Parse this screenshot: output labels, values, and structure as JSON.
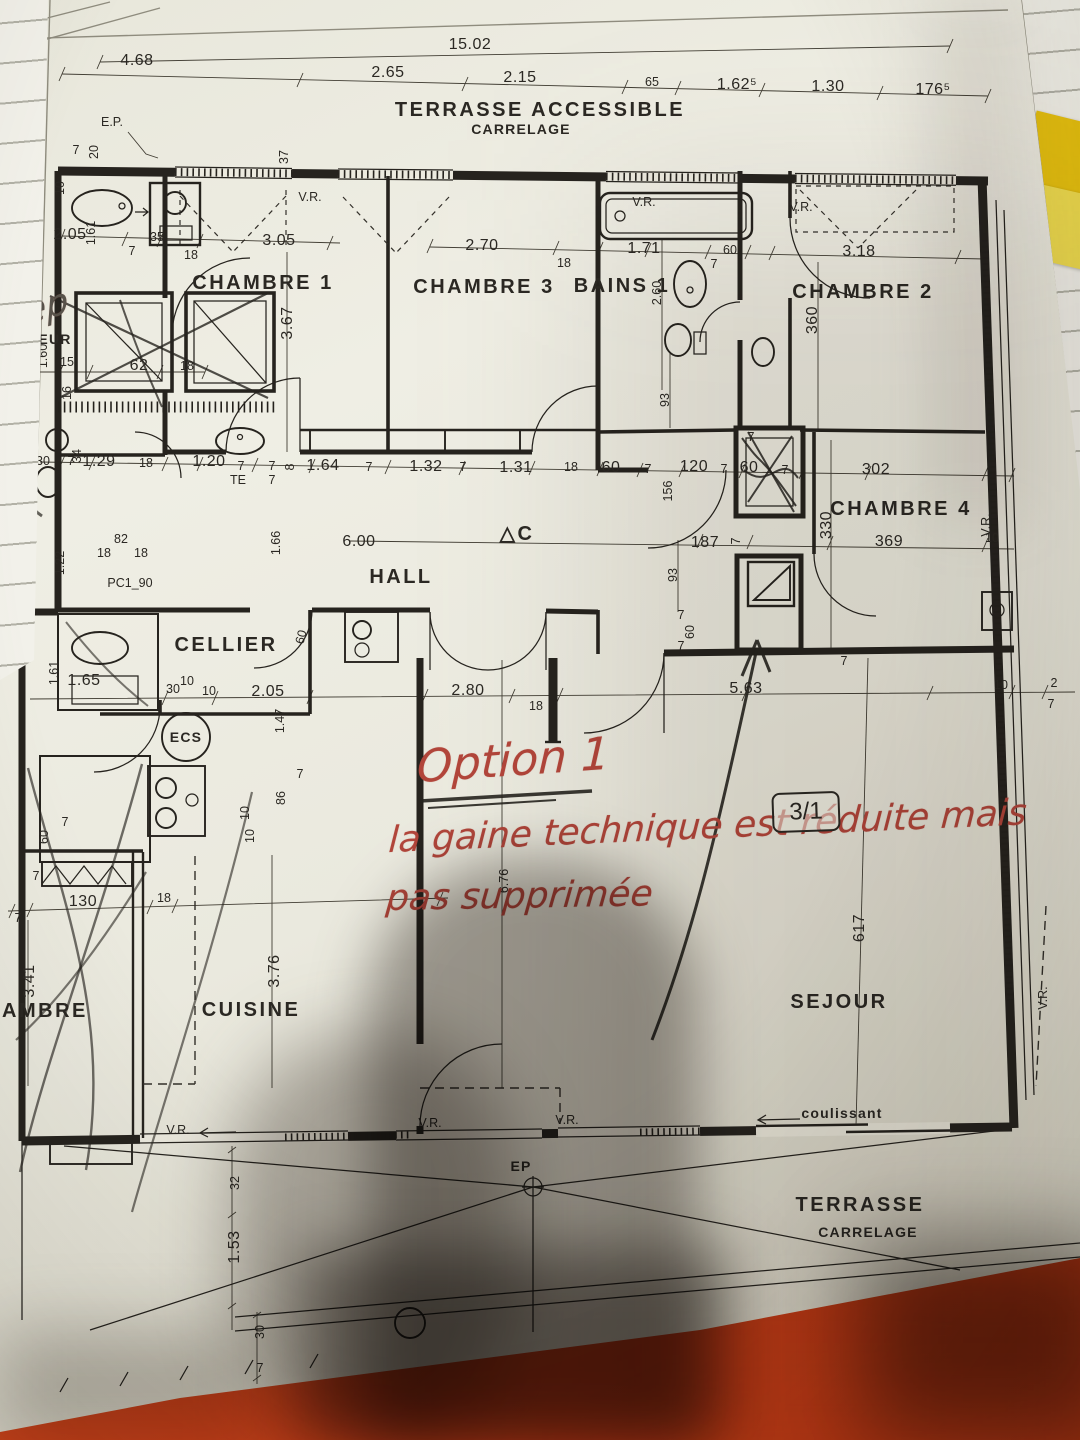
{
  "scene": {
    "table_color": "#c93c15",
    "paper_color": "#eae9de",
    "sticky_colors": [
      "#e8c20e",
      "#f0dd4e"
    ],
    "ink_color": "#26231e",
    "red_ink_color": "#b0453c"
  },
  "annotations": {
    "pencil_note": "Dep",
    "red_title": "Option 1",
    "red_line1": "la gaine technique est réduite mais",
    "red_line2": "pas supprimée",
    "plan_ref": "3/1"
  },
  "plan": {
    "texts": [
      {
        "t": "15.02",
        "x": 470,
        "y": 49,
        "k": "d"
      },
      {
        "t": "4.68",
        "x": 137,
        "y": 65,
        "k": "d"
      },
      {
        "t": "2.65",
        "x": 388,
        "y": 77,
        "k": "d"
      },
      {
        "t": "2.15",
        "x": 520,
        "y": 82,
        "k": "d"
      },
      {
        "t": "65",
        "x": 652,
        "y": 86,
        "k": "t"
      },
      {
        "t": "1.62⁵",
        "x": 737,
        "y": 89,
        "k": "d"
      },
      {
        "t": "1.30",
        "x": 828,
        "y": 91,
        "k": "d"
      },
      {
        "t": "176⁵",
        "x": 933,
        "y": 94,
        "k": "d"
      },
      {
        "t": "TERRASSE ACCESSIBLE",
        "x": 540,
        "y": 116,
        "k": "r"
      },
      {
        "t": "CARRELAGE",
        "x": 521,
        "y": 134,
        "k": "l"
      },
      {
        "t": "E.P.",
        "x": 112,
        "y": 126,
        "k": "t"
      },
      {
        "t": "7",
        "x": 76,
        "y": 154,
        "k": "t"
      },
      {
        "t": "20",
        "x": 98,
        "y": 152,
        "k": "t",
        "r": -90
      },
      {
        "t": "37",
        "x": 288,
        "y": 157,
        "k": "t",
        "r": -90
      },
      {
        "t": "10",
        "x": 64,
        "y": 188,
        "k": "t",
        "r": -90
      },
      {
        "t": "V.R.",
        "x": 310,
        "y": 201,
        "k": "t"
      },
      {
        "t": "V.R.",
        "x": 644,
        "y": 206,
        "k": "t"
      },
      {
        "t": "V.R.",
        "x": 801,
        "y": 211,
        "k": "t"
      },
      {
        "t": "2.05",
        "x": 70,
        "y": 239,
        "k": "d"
      },
      {
        "t": "1.61",
        "x": 95,
        "y": 233,
        "k": "t",
        "r": -90
      },
      {
        "t": "35",
        "x": 157,
        "y": 241,
        "k": "t"
      },
      {
        "t": "7",
        "x": 132,
        "y": 255,
        "k": "t"
      },
      {
        "t": "18",
        "x": 191,
        "y": 259,
        "k": "t"
      },
      {
        "t": "3.05",
        "x": 279,
        "y": 245,
        "k": "d"
      },
      {
        "t": "2.70",
        "x": 482,
        "y": 250,
        "k": "d"
      },
      {
        "t": "18",
        "x": 564,
        "y": 267,
        "k": "t"
      },
      {
        "t": "1.71",
        "x": 644,
        "y": 253,
        "k": "d"
      },
      {
        "t": "7",
        "x": 714,
        "y": 268,
        "k": "t"
      },
      {
        "t": "60",
        "x": 730,
        "y": 254,
        "k": "t"
      },
      {
        "t": "3.18",
        "x": 859,
        "y": 256,
        "k": "d"
      },
      {
        "t": "CHAMBRE 1",
        "x": 263,
        "y": 289,
        "k": "r"
      },
      {
        "t": "CHAMBRE 3",
        "x": 484,
        "y": 293,
        "k": "r"
      },
      {
        "t": "BAINS 1",
        "x": 622,
        "y": 292,
        "k": "r"
      },
      {
        "t": "CHAMBRE 2",
        "x": 863,
        "y": 298,
        "k": "r"
      },
      {
        "t": "3.67",
        "x": 292,
        "y": 323,
        "k": "d",
        "r": -90
      },
      {
        "t": "2.60",
        "x": 661,
        "y": 293,
        "k": "t",
        "r": -90
      },
      {
        "t": "360",
        "x": 817,
        "y": 320,
        "k": "d",
        "r": -90
      },
      {
        "t": "EUR",
        "x": 55,
        "y": 344,
        "k": "l"
      },
      {
        "t": "1.60",
        "x": 47,
        "y": 356,
        "k": "t",
        "r": -90
      },
      {
        "t": "50",
        "x": 18,
        "y": 365,
        "k": "t"
      },
      {
        "t": "15",
        "x": 67,
        "y": 366,
        "k": "t"
      },
      {
        "t": "62",
        "x": 139,
        "y": 370,
        "k": "d"
      },
      {
        "t": "18",
        "x": 187,
        "y": 370,
        "k": "t"
      },
      {
        "t": "16",
        "x": 71,
        "y": 393,
        "k": "t",
        "r": -90
      },
      {
        "t": "93",
        "x": 669,
        "y": 400,
        "k": "t",
        "r": -90
      },
      {
        "t": "30",
        "x": 43,
        "y": 465,
        "k": "t"
      },
      {
        "t": "7",
        "x": 71,
        "y": 465,
        "k": "t"
      },
      {
        "t": "1.29",
        "x": 99,
        "y": 466,
        "k": "d"
      },
      {
        "t": "18",
        "x": 146,
        "y": 467,
        "k": "t"
      },
      {
        "t": "34",
        "x": 81,
        "y": 456,
        "k": "t",
        "r": -90
      },
      {
        "t": "1.20",
        "x": 209,
        "y": 466,
        "k": "d"
      },
      {
        "t": "7",
        "x": 241,
        "y": 470,
        "k": "t"
      },
      {
        "t": "TE",
        "x": 238,
        "y": 484,
        "k": "t"
      },
      {
        "t": "7",
        "x": 272,
        "y": 470,
        "k": "t"
      },
      {
        "t": "7",
        "x": 272,
        "y": 484,
        "k": "t"
      },
      {
        "t": "8",
        "x": 294,
        "y": 467,
        "k": "t",
        "r": -90
      },
      {
        "t": "1.64",
        "x": 323,
        "y": 470,
        "k": "d"
      },
      {
        "t": "7",
        "x": 369,
        "y": 471,
        "k": "t"
      },
      {
        "t": "1.32",
        "x": 426,
        "y": 471,
        "k": "d"
      },
      {
        "t": "7",
        "x": 463,
        "y": 471,
        "k": "t"
      },
      {
        "t": "1.31",
        "x": 516,
        "y": 472,
        "k": "d"
      },
      {
        "t": "18",
        "x": 571,
        "y": 471,
        "k": "t"
      },
      {
        "t": "60",
        "x": 611,
        "y": 472,
        "k": "d"
      },
      {
        "t": "7",
        "x": 648,
        "y": 473,
        "k": "t"
      },
      {
        "t": "120",
        "x": 694,
        "y": 471,
        "k": "d"
      },
      {
        "t": "7",
        "x": 724,
        "y": 473,
        "k": "t"
      },
      {
        "t": "60",
        "x": 749,
        "y": 472,
        "k": "d"
      },
      {
        "t": "7",
        "x": 785,
        "y": 474,
        "k": "t"
      },
      {
        "t": "302",
        "x": 876,
        "y": 474,
        "k": "d"
      },
      {
        "t": "156",
        "x": 672,
        "y": 491,
        "k": "t",
        "r": -90
      },
      {
        "t": "7",
        "x": 751,
        "y": 441,
        "k": "t"
      },
      {
        "t": "CHAMBRE 4",
        "x": 901,
        "y": 515,
        "k": "r"
      },
      {
        "t": "330",
        "x": 831,
        "y": 525,
        "k": "d",
        "r": -90
      },
      {
        "t": "V.R.",
        "x": 990,
        "y": 525,
        "k": "t",
        "r": -90
      },
      {
        "t": "10",
        "x": 992,
        "y": 542,
        "k": "t"
      },
      {
        "t": "369",
        "x": 889,
        "y": 546,
        "k": "d"
      },
      {
        "t": "187",
        "x": 705,
        "y": 547,
        "k": "d"
      },
      {
        "t": "7",
        "x": 740,
        "y": 541,
        "k": "t",
        "r": -90
      },
      {
        "t": "△C",
        "x": 517,
        "y": 540,
        "k": "r"
      },
      {
        "t": "1.66",
        "x": 280,
        "y": 543,
        "k": "t",
        "r": -90
      },
      {
        "t": "6.00",
        "x": 359,
        "y": 546,
        "k": "d"
      },
      {
        "t": "1.22",
        "x": 64,
        "y": 563,
        "k": "t",
        "r": -90
      },
      {
        "t": "82",
        "x": 121,
        "y": 543,
        "k": "t"
      },
      {
        "t": "18",
        "x": 104,
        "y": 557,
        "k": "t"
      },
      {
        "t": "18",
        "x": 141,
        "y": 557,
        "k": "t"
      },
      {
        "t": "HALL",
        "x": 401,
        "y": 583,
        "k": "r"
      },
      {
        "t": "PC1_90",
        "x": 130,
        "y": 587,
        "k": "t"
      },
      {
        "t": "93",
        "x": 677,
        "y": 575,
        "k": "t",
        "r": -90
      },
      {
        "t": "7",
        "x": 681,
        "y": 619,
        "k": "t"
      },
      {
        "t": "60",
        "x": 694,
        "y": 632,
        "k": "t",
        "r": -90
      },
      {
        "t": "7",
        "x": 681,
        "y": 650,
        "k": "t"
      },
      {
        "t": "7",
        "x": 844,
        "y": 665,
        "k": "t"
      },
      {
        "t": "CELLIER",
        "x": 226,
        "y": 651,
        "k": "r"
      },
      {
        "t": "60",
        "x": 305,
        "y": 638,
        "k": "t",
        "r": -75
      },
      {
        "t": "1.61",
        "x": 58,
        "y": 673,
        "k": "t",
        "r": -90
      },
      {
        "t": "1.65",
        "x": 84,
        "y": 685,
        "k": "d"
      },
      {
        "t": "30",
        "x": 173,
        "y": 693,
        "k": "t"
      },
      {
        "t": "10",
        "x": 187,
        "y": 685,
        "k": "t"
      },
      {
        "t": "10",
        "x": 209,
        "y": 695,
        "k": "t"
      },
      {
        "t": "2.05",
        "x": 268,
        "y": 696,
        "k": "d"
      },
      {
        "t": "1.47",
        "x": 284,
        "y": 721,
        "k": "t",
        "r": -90
      },
      {
        "t": "2.80",
        "x": 468,
        "y": 695,
        "k": "d"
      },
      {
        "t": "18",
        "x": 536,
        "y": 710,
        "k": "t"
      },
      {
        "t": "5.63",
        "x": 746,
        "y": 693,
        "k": "d"
      },
      {
        "t": "10",
        "x": 1001,
        "y": 689,
        "k": "t"
      },
      {
        "t": "2",
        "x": 1054,
        "y": 687,
        "k": "t"
      },
      {
        "t": "7",
        "x": 1051,
        "y": 708,
        "k": "t"
      },
      {
        "t": "ECS",
        "x": 186,
        "y": 742,
        "k": "l"
      },
      {
        "t": "7",
        "x": 300,
        "y": 778,
        "k": "t"
      },
      {
        "t": "86",
        "x": 285,
        "y": 798,
        "k": "t",
        "r": -90
      },
      {
        "t": "10",
        "x": 249,
        "y": 813,
        "k": "t",
        "r": -90
      },
      {
        "t": "10",
        "x": 254,
        "y": 836,
        "k": "t",
        "r": -90
      },
      {
        "t": "60",
        "x": 48,
        "y": 837,
        "k": "t",
        "r": -90
      },
      {
        "t": "7",
        "x": 65,
        "y": 826,
        "k": "t"
      },
      {
        "t": "7",
        "x": 36,
        "y": 880,
        "k": "t"
      },
      {
        "t": "130",
        "x": 83,
        "y": 906,
        "k": "d"
      },
      {
        "t": "18",
        "x": 164,
        "y": 902,
        "k": "t"
      },
      {
        "t": "7",
        "x": 18,
        "y": 922,
        "k": "t"
      },
      {
        "t": "3.41",
        "x": 34,
        "y": 981,
        "k": "d",
        "r": -90
      },
      {
        "t": "CHAMBRE",
        "x": 28,
        "y": 1017,
        "k": "r"
      },
      {
        "t": "CUISINE",
        "x": 251,
        "y": 1016,
        "k": "r"
      },
      {
        "t": "3.76",
        "x": 279,
        "y": 971,
        "k": "d",
        "r": -90
      },
      {
        "t": "6.76",
        "x": 508,
        "y": 881,
        "k": "t",
        "r": -90
      },
      {
        "t": "617",
        "x": 864,
        "y": 928,
        "k": "d",
        "r": -90
      },
      {
        "t": "SEJOUR",
        "x": 839,
        "y": 1008,
        "k": "r"
      },
      {
        "t": "V.R.",
        "x": 1047,
        "y": 998,
        "k": "t",
        "r": -90
      },
      {
        "t": "V.R.",
        "x": 178,
        "y": 1134,
        "k": "t"
      },
      {
        "t": "V.R.",
        "x": 430,
        "y": 1127,
        "k": "t"
      },
      {
        "t": "V.R.",
        "x": 567,
        "y": 1124,
        "k": "t"
      },
      {
        "t": "coulissant",
        "x": 842,
        "y": 1118,
        "k": "l"
      },
      {
        "t": "EP",
        "x": 521,
        "y": 1171,
        "k": "l"
      },
      {
        "t": "32",
        "x": 239,
        "y": 1183,
        "k": "t",
        "r": -90
      },
      {
        "t": "1.53",
        "x": 239,
        "y": 1247,
        "k": "d",
        "r": -90
      },
      {
        "t": "TERRASSE",
        "x": 860,
        "y": 1211,
        "k": "r"
      },
      {
        "t": "CARRELAGE",
        "x": 868,
        "y": 1237,
        "k": "l"
      },
      {
        "t": "30",
        "x": 264,
        "y": 1332,
        "k": "t",
        "r": -90
      },
      {
        "t": "7",
        "x": 260,
        "y": 1372,
        "k": "t"
      }
    ]
  }
}
